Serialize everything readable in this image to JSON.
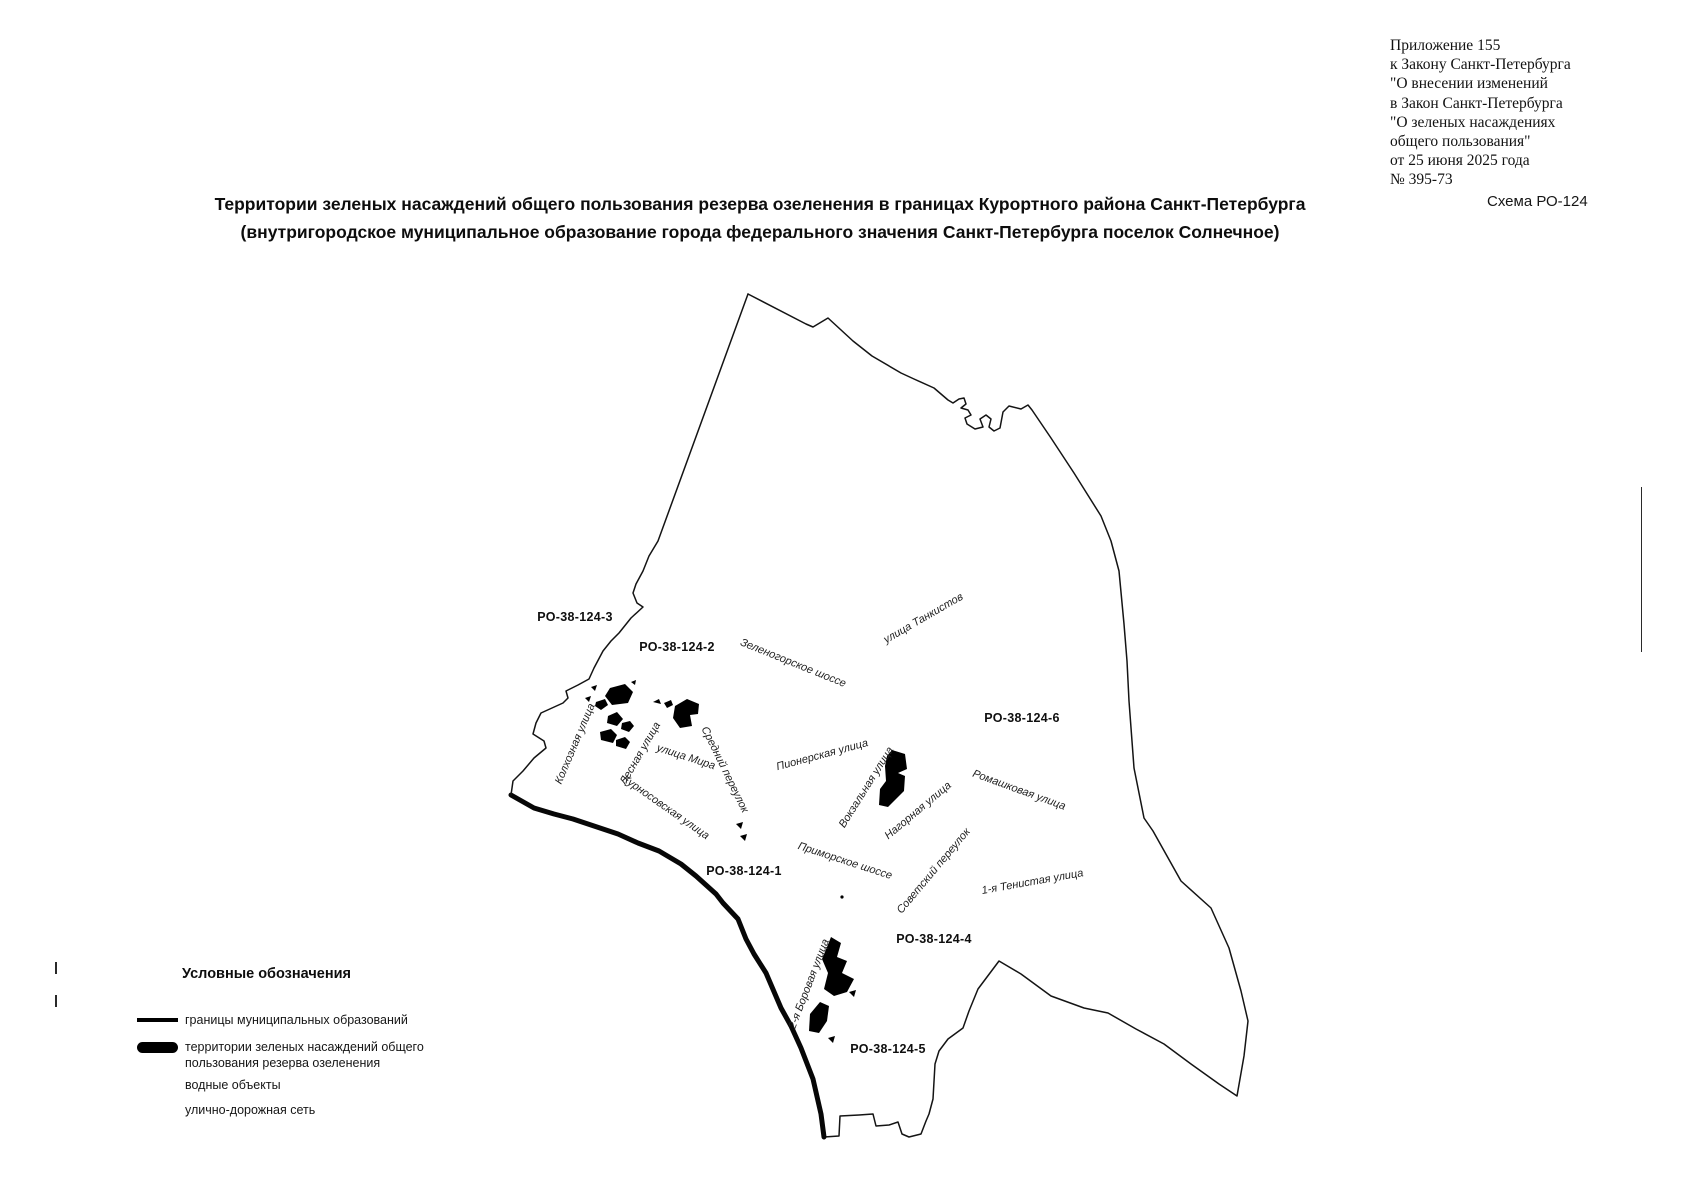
{
  "annex": {
    "lines": [
      "Приложение 155",
      "к Закону Санкт-Петербурга",
      "\"О внесении изменений",
      "в Закон Санкт-Петербурга",
      "\"О зеленых насаждениях",
      "общего пользования\"",
      "от 25 июня 2025 года",
      "№ 395-73"
    ]
  },
  "scheme_label": "Схема РО-124",
  "title": {
    "line1": "Территории зеленых насаждений общего пользования резерва озеленения в границах Курортного района Санкт-Петербурга",
    "line2": "(внутригородское муниципальное образование города федерального значения Санкт-Петербурга поселок Солнечное)"
  },
  "map": {
    "colors": {
      "boundary": "#141414",
      "green_area": "#000000"
    },
    "area_codes": [
      {
        "text": "РО-38-124-3"
      },
      {
        "text": "РО-38-124-2"
      },
      {
        "text": "РО-38-124-6"
      },
      {
        "text": "РО-38-124-1"
      },
      {
        "text": "РО-38-124-4"
      },
      {
        "text": "РО-38-124-5"
      }
    ],
    "streets": [
      {
        "name": "Зеленогорское шоссе"
      },
      {
        "name": "улица Танкистов"
      },
      {
        "name": "Колхозная улица"
      },
      {
        "name": "Лесная улица"
      },
      {
        "name": "улица Мира"
      },
      {
        "name": "Средний переулок"
      },
      {
        "name": "Курносовская улица"
      },
      {
        "name": "Пионерская улица"
      },
      {
        "name": "Вокзальная улица"
      },
      {
        "name": "Нагорная улица"
      },
      {
        "name": "Ромашковая улица"
      },
      {
        "name": "Приморское шоссе"
      },
      {
        "name": "Советский переулок"
      },
      {
        "name": "1-я Тенистая улица"
      },
      {
        "name": "2-я Боровая улица"
      }
    ]
  },
  "legend": {
    "title": "Условные обозначения",
    "items": [
      {
        "label": "границы муниципальных образований"
      },
      {
        "label": "территории зеленых насаждений общего пользования резерва озеленения"
      },
      {
        "label": "водные объекты"
      },
      {
        "label": "улично-дорожная сеть"
      }
    ]
  }
}
